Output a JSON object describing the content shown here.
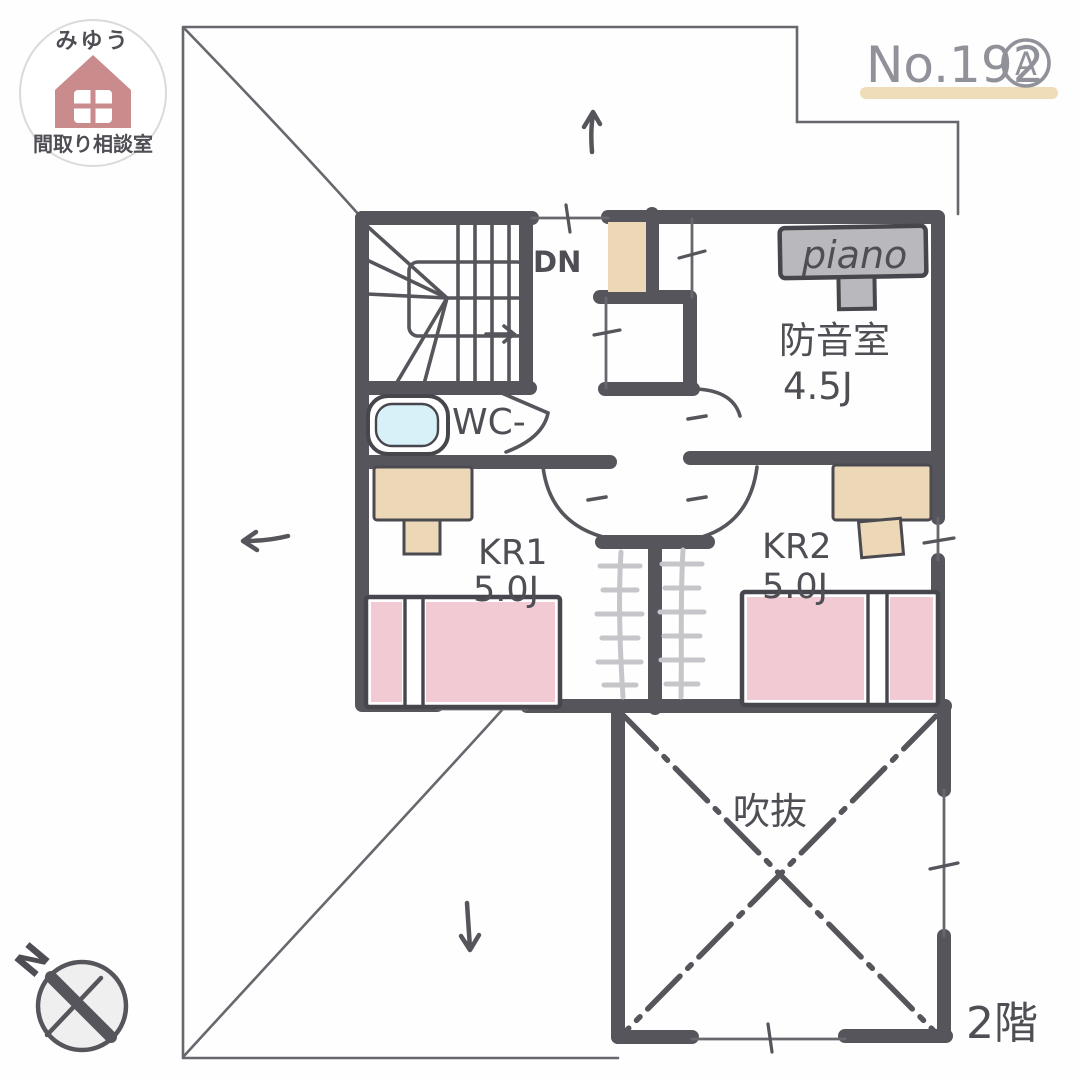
{
  "plan": {
    "number": "No.192",
    "variant": "A",
    "floor": "2階"
  },
  "logo": {
    "studio_name": "みゆう",
    "studio_subtitle": "間取り相談室"
  },
  "compass": {
    "north": "N"
  },
  "rooms": {
    "soundproof": {
      "name": "防音室",
      "size": "4.5J"
    },
    "kids_room_1": {
      "name": "KR1",
      "size": "5.0J"
    },
    "kids_room_2": {
      "name": "KR2",
      "size": "5.0J"
    },
    "toilet": {
      "label": "WC-"
    },
    "stairs": {
      "label": "DN"
    },
    "void": {
      "label": "吹抜"
    }
  },
  "furniture": {
    "piano": "piano"
  },
  "colors": {
    "wall": "#55555b",
    "thin_line": "#67676d",
    "bed_pink": "#f2cad4",
    "wood_tan": "#ecd7b6",
    "piano_gray": "#b9b9bd",
    "toilet_blue": "#d8f1f8",
    "hanger_gray": "#c6c6ca",
    "logo_rose": "#c98b8b",
    "highlight_tan": "#efdcb9",
    "ink": "#4e4e54",
    "number_gray": "#91919a"
  }
}
